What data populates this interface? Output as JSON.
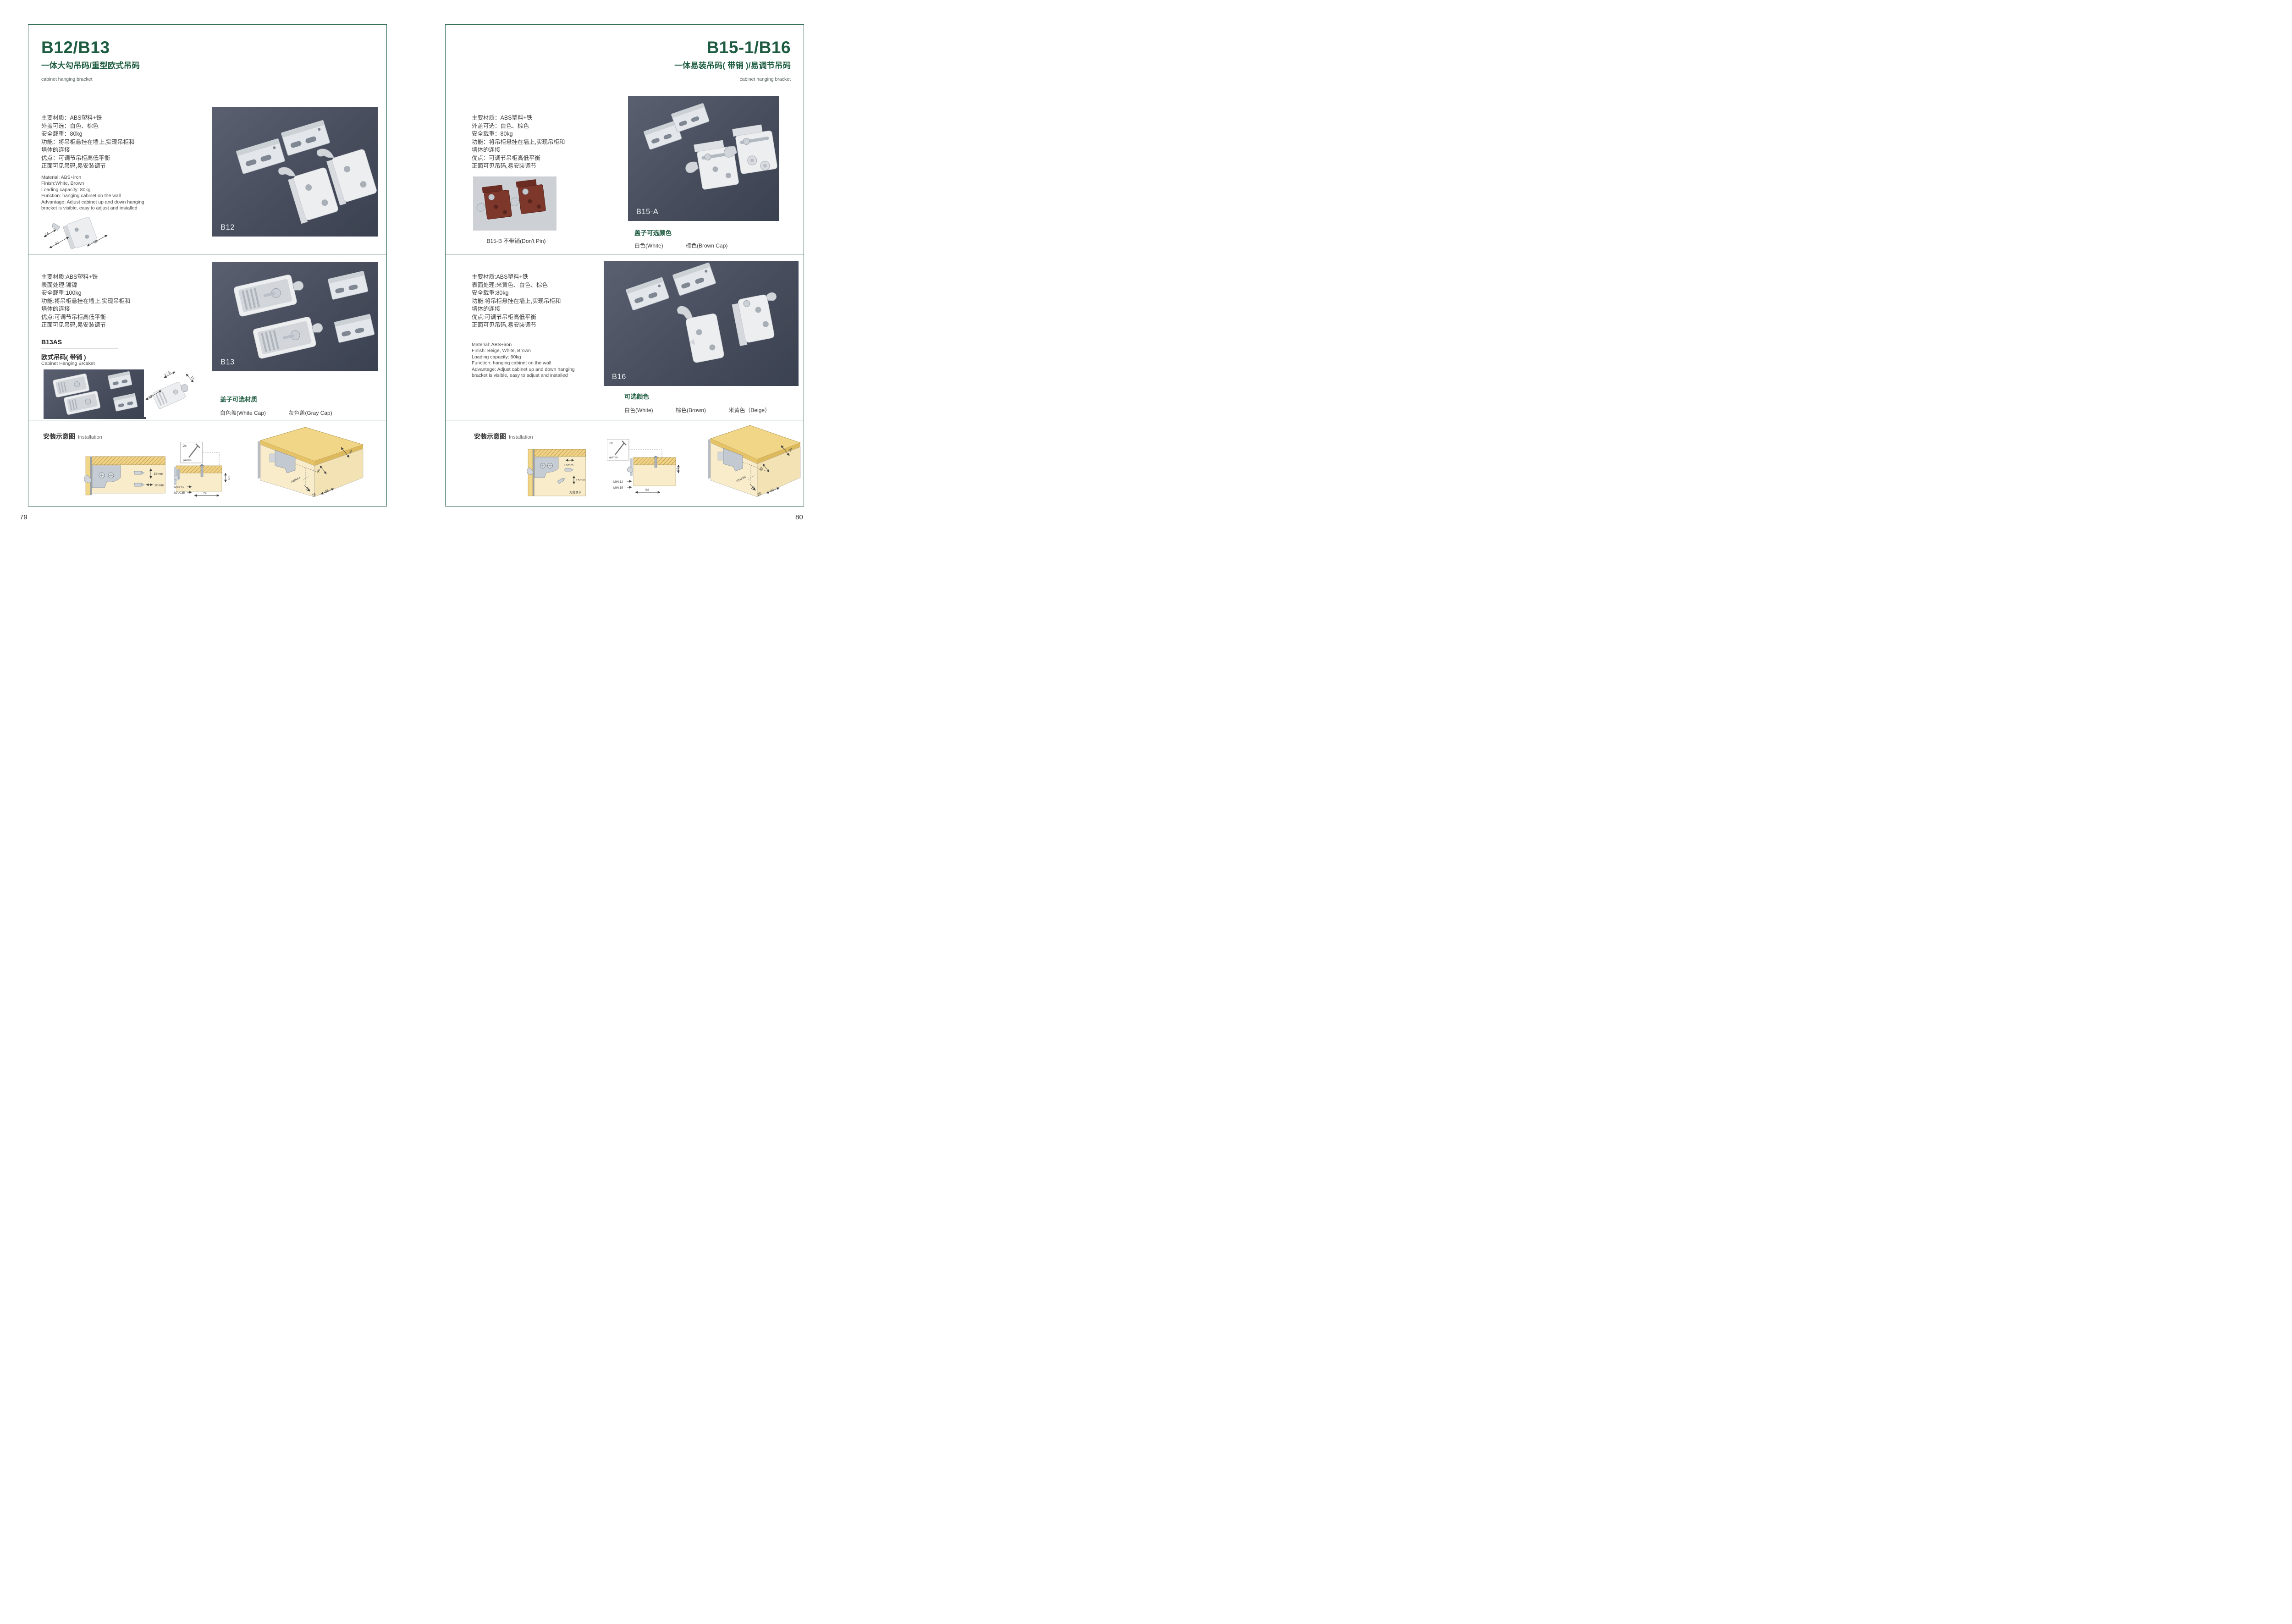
{
  "accent_color": "#1e5c41",
  "photo_bg_color": "#474d5c",
  "pages": [
    {
      "page_number": "79",
      "header": {
        "title": "B12/B13",
        "subtitle": "一体大勾吊码/重型欧式吊码",
        "caption": "cabinet hanging bracket"
      },
      "section1": {
        "specs_cn": [
          "主要材质：ABS塑料+铁",
          "外盖可选：白色、棕色",
          "安全载重：80kg",
          "功能：将吊柜悬挂在墙上,实现吊柜和",
          "墙体的连接",
          "优点：可调节吊柜高低平衡",
          "正面可见吊码,易安装调节"
        ],
        "specs_en": [
          "Material: ABS+iron",
          "Finish:White, Brown",
          "Loading capacity: 80kg",
          "Function: hanging cabinet on the wall",
          "Advantage: Adjust cabinet up and down hanging",
          "bracket is visible, easy to adjust and installed"
        ],
        "diagram_dims": {
          "d1": "14",
          "d2": "32",
          "d3": "32"
        },
        "photo_label": "B12"
      },
      "section2": {
        "specs_cn": [
          "主要材质:ABS塑料+铁",
          "表面处理:镀镍",
          "安全载重:100kg",
          "功能:将吊柜悬挂在墙上,实现吊柜和",
          "墙体的连接",
          "优点:可调节吊柜高低平衡",
          "正面可见吊码,易安装调节"
        ],
        "model_code": "B13AS",
        "model_name_cn": "欧式吊码( 带销 )",
        "model_name_en": "Cabinet Hanging Brcaket",
        "diagram_dims": {
          "d1": "32",
          "d2": "17.5",
          "d3": "14"
        },
        "photo_label": "B13",
        "options_title": "盖子可选材质",
        "options": [
          "白色盖(White Cap)",
          "灰色盖(Gray Cap)"
        ]
      },
      "installation": {
        "title_cn": "安装示意图",
        "title_en": "Installation",
        "diagram1": {
          "dim1": "15mm",
          "dim2": "20mm"
        },
        "diagram2": {
          "screw_count": "2x",
          "screw_dia": "φ4mm",
          "depth": "18",
          "min": "MIN.15",
          "max": "MAX.35",
          "width": "58"
        },
        "diagram3": {
          "d1": "16",
          "d2": "40",
          "d3": "RMAX4",
          "d4": "19",
          "d5": "18",
          "d6": "32"
        }
      }
    },
    {
      "page_number": "80",
      "header": {
        "title": "B15-1/B16",
        "subtitle": "一体易装吊码( 带销 )/易调节吊码",
        "caption": "cabinet hanging bracket"
      },
      "section1": {
        "specs_cn": [
          "主要材质：ABS塑料+铁",
          "外盖可选：白色、棕色",
          "安全载重：80kg",
          "功能：将吊柜悬挂在墙上,实现吊柜和",
          "墙体的连接",
          "优点：可调节吊柜高低平衡",
          "正面可见吊码,易安装调节"
        ],
        "small_photo_caption": "B15-B 不带销(Don't Pin)",
        "photo_label": "B15-A",
        "options_title": "盖子可选颜色",
        "options": [
          "白色(White)",
          "棕色(Brown Cap)"
        ]
      },
      "section2": {
        "specs_cn": [
          "主要材质:ABS塑料+铁",
          "表面处理:米黄色、白色、棕色",
          "安全载重:80kg",
          "功能:将吊柜悬挂在墙上,实现吊柜和",
          "墙体的连接",
          "优点:可调节吊柜高低平衡",
          "正面可见吊码,易安装调节"
        ],
        "specs_en": [
          "Material: ABS+iron",
          "Finish: Beige, White, Brown",
          "Loading capacity: 80kg",
          "Function: hanging cabinet on the wall",
          "Advantage: Adjust cabinet up and down hanging",
          "bracket is visible, easy to adjust and installed"
        ],
        "photo_label": "B16",
        "options_title": "可选颜色",
        "options": [
          "白色(White)",
          "棕色(Brown)",
          "米黄色（Beige）"
        ]
      },
      "installation": {
        "title_cn": "安装示意图",
        "title_en": "Installation",
        "diagram1": {
          "dim1": "15mm",
          "dim2": "15mm",
          "note": "方便调节"
        },
        "diagram2": {
          "screw_count": "2x",
          "screw_dia": "φ4mm",
          "depth": "19",
          "min": "MIN.12",
          "max": "MIN.15",
          "width": "58"
        },
        "diagram3": {
          "d1": "30",
          "d2": "32",
          "d3": "RMAX4",
          "d4": "19",
          "d5": "20",
          "d6": "32"
        }
      }
    }
  ]
}
